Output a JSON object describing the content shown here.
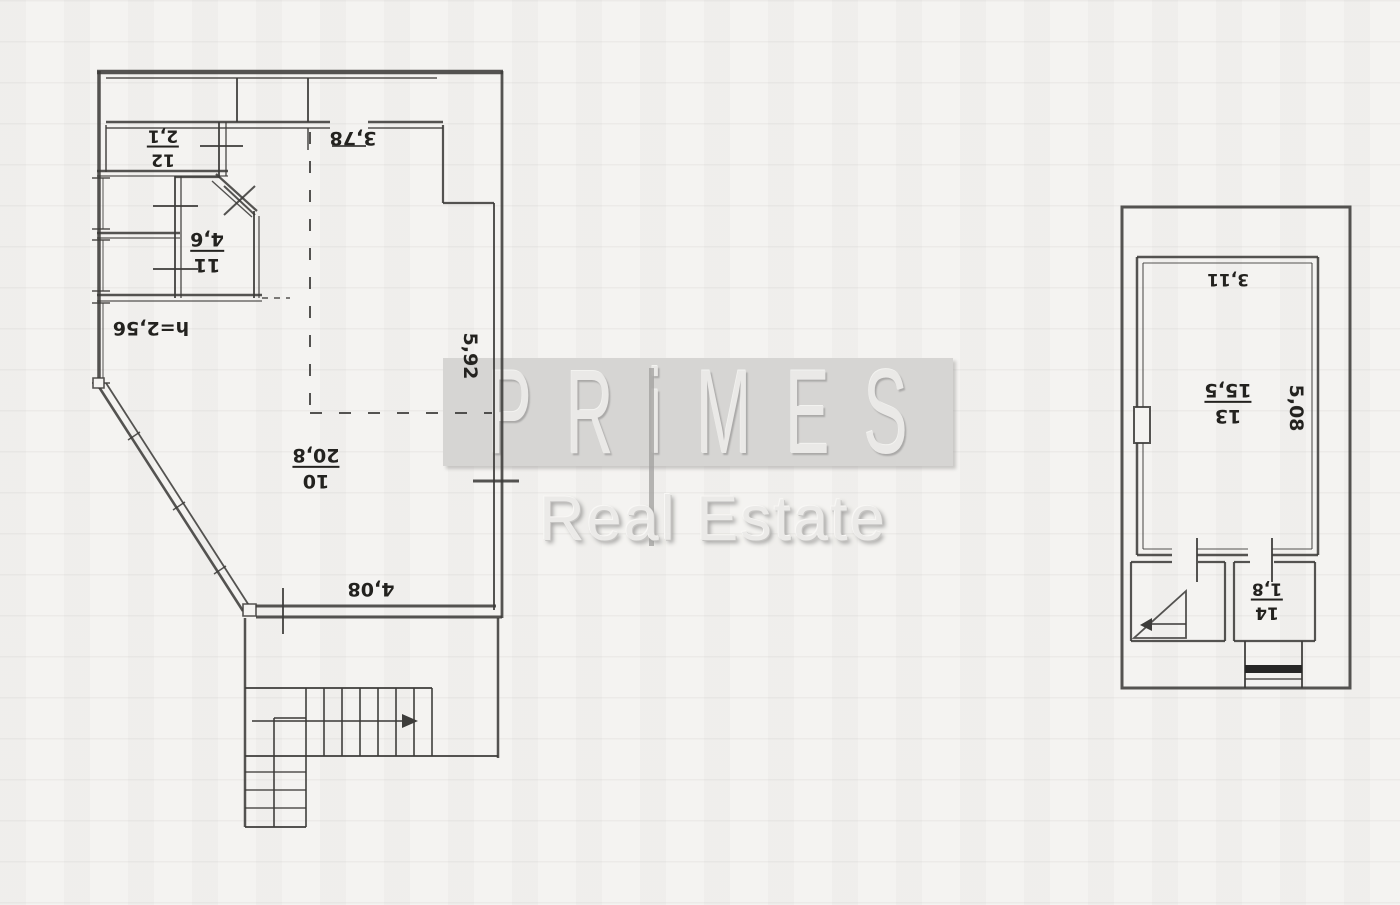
{
  "watermark": {
    "brand": "PRiMES",
    "tagline": "Real Estate"
  },
  "left_plan": {
    "room_10": {
      "number": "10",
      "area": "20,8"
    },
    "room_11": {
      "number": "11",
      "area": "4,6"
    },
    "room_12": {
      "number": "12",
      "area": "2,1"
    },
    "dim_top": "3,78",
    "dim_right": "5,92",
    "dim_bottom": "4,08",
    "ceiling_height": "h=2,56"
  },
  "right_plan": {
    "room_13": {
      "number": "13",
      "area": "15,5"
    },
    "room_14": {
      "number": "14",
      "area": "1,8"
    },
    "dim_top": "3,11",
    "dim_right": "5,08"
  },
  "colors": {
    "ink": "#3d3c3a",
    "paper": "#f4f3f1",
    "watermark_band": "#d6d5d3",
    "watermark_letters": "#eae9e7",
    "tagline_text": "#ebeae8",
    "porch_threshold": "#262626"
  }
}
